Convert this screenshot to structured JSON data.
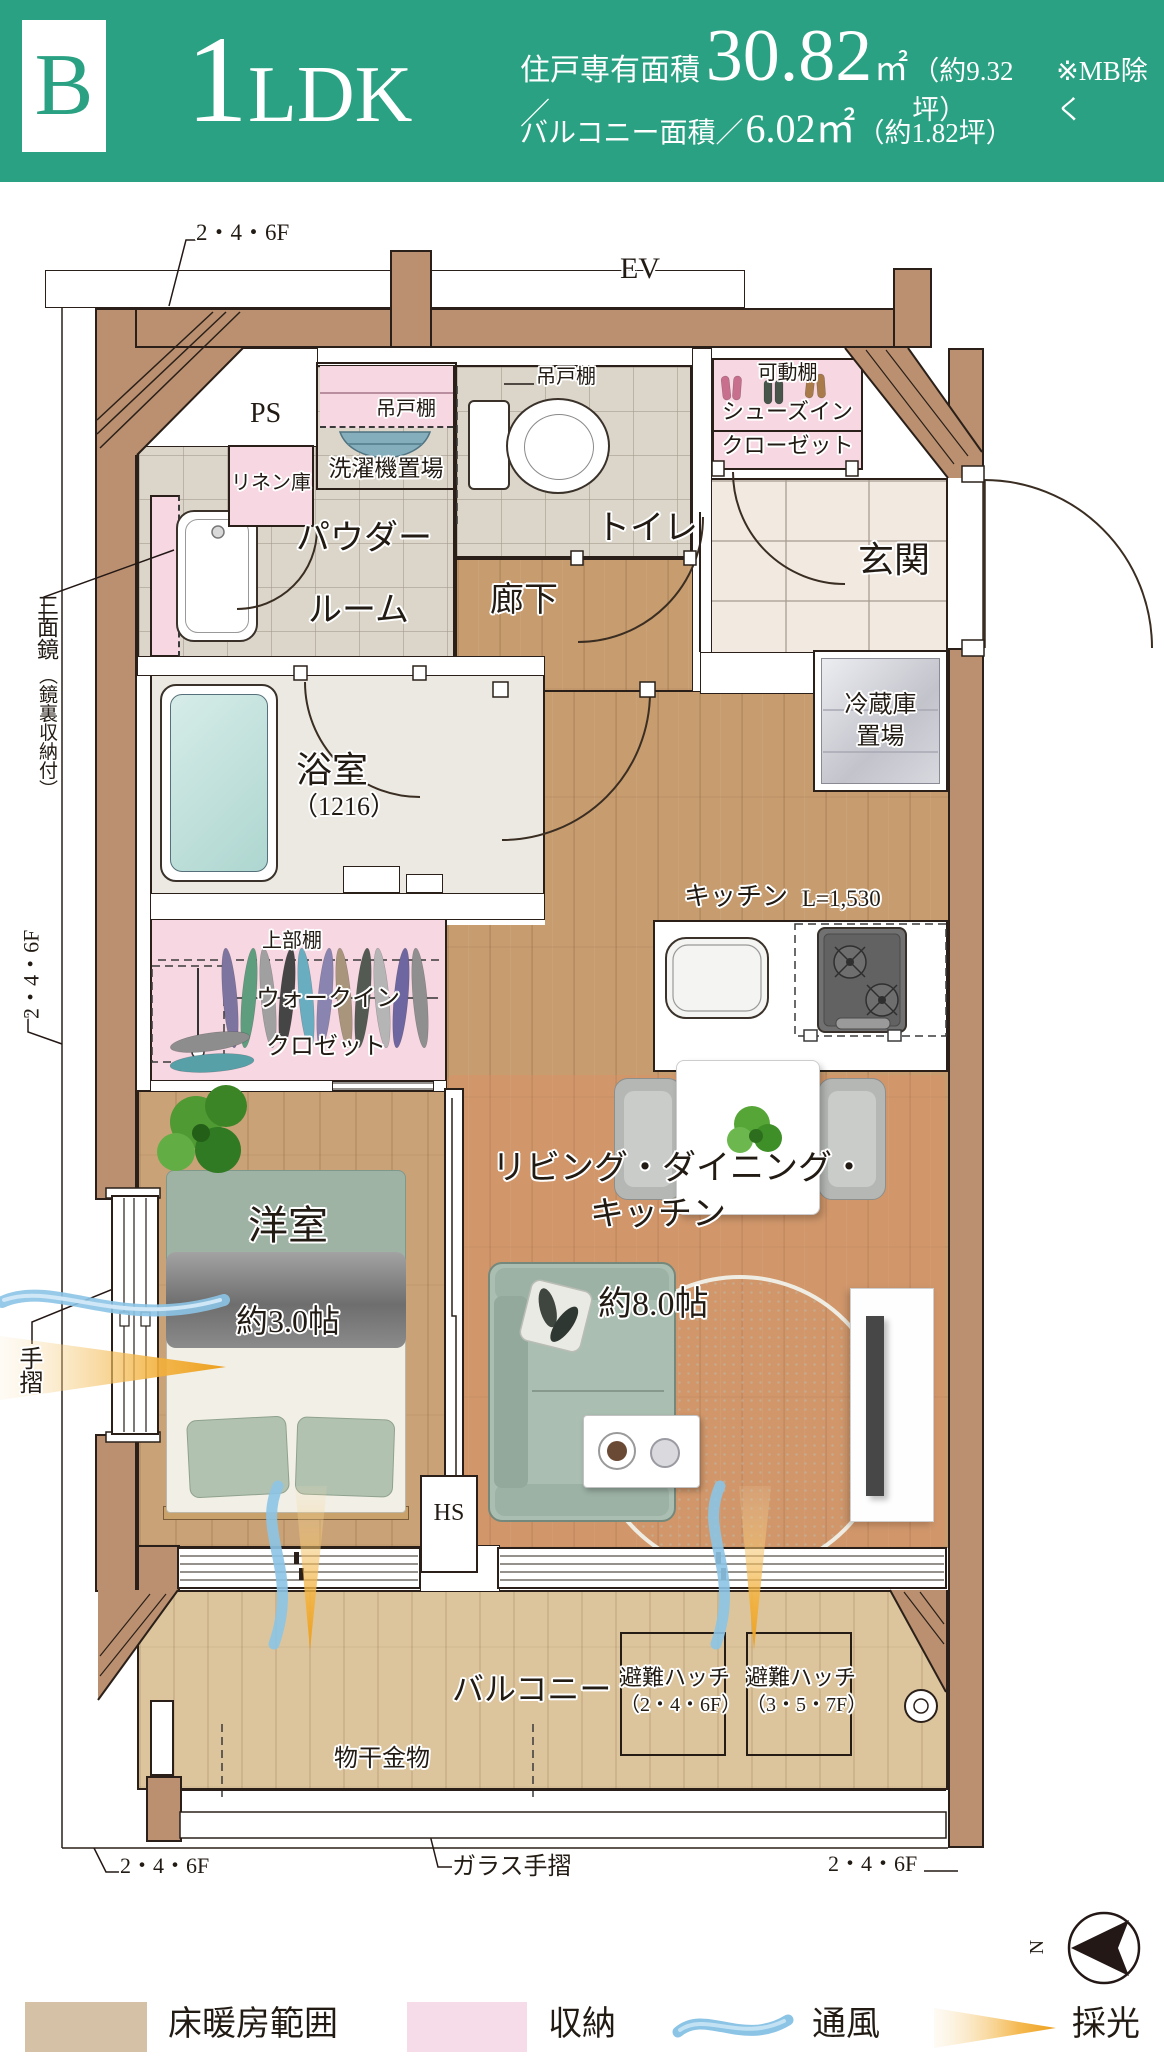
{
  "header": {
    "unit": "B",
    "plan_num": "1",
    "plan_type": "LDK",
    "area_label": "住戸専有面積／",
    "area_value": "30.82",
    "area_unit": "㎡",
    "area_tsubo": "（約9.32坪）",
    "area_note": "※MB除く",
    "balcony_label": "バルコニー面積／",
    "balcony_value": "6.02㎡",
    "balcony_tsubo": "（約1.82坪）"
  },
  "labels": {
    "floor_note_top": "2・4・6F",
    "floor_note_left": "2・4・6F",
    "floor_note_bottom_left": "2・4・6F",
    "floor_note_bottom_right": "2・4・6F",
    "ev": "EV",
    "ps": "PS",
    "hanging_shelf": "吊戸棚",
    "laundry": "洗濯機置場",
    "linen": "リネン庫",
    "toilet": "トイレ",
    "toilet_shelf": "吊戸棚",
    "movable_shelf": "可動棚",
    "sic_line1": "シューズイン",
    "sic_line2": "クローゼット",
    "genkan": "玄関",
    "powder_line1": "パウダー",
    "powder_line2": "ルーム",
    "corridor": "廊下",
    "fridge_line1": "冷蔵庫",
    "fridge_line2": "置場",
    "mirror_line1": "三面鏡",
    "mirror_line2": "（鏡裏収納付）",
    "bath": "浴室",
    "bath_size": "（1216）",
    "kitchen": "キッチン",
    "kitchen_size": "L=1,530",
    "wic_upper": "上部棚",
    "wic_line1": "ウォークイン",
    "wic_line2": "クロゼット",
    "bedroom": "洋室",
    "bedroom_size": "約3.0帖",
    "ldk_line1": "リビング・ダイニング・",
    "ldk_line2": "キッチン",
    "ldk_size": "約8.0帖",
    "hs": "HS",
    "handrail": "手摺",
    "balcony": "バルコニー",
    "laundry_pole": "物干金物",
    "hatch": "避難ハッチ",
    "hatch1_floors": "（2・4・6F）",
    "hatch2_floors": "（3・5・7F）",
    "glass_rail": "ガラス手摺",
    "compass_n": "N"
  },
  "legend": {
    "items": [
      {
        "type": "swatch",
        "color": "#d5c1a6",
        "label": "床暖房範囲"
      },
      {
        "type": "swatch",
        "color": "#f5dce8",
        "label": "収納"
      },
      {
        "type": "wave",
        "color": "#8cc4e6",
        "label": "通風"
      },
      {
        "type": "beam",
        "color": "#f0a32c",
        "label": "採光"
      }
    ]
  },
  "colors": {
    "header_green": "#2aa183",
    "wall_brown": "#bb9070",
    "wood_floor": "#c79c6f",
    "balcony_floor": "#dcc59d",
    "tile_gray": "#dbd6c9",
    "genkan_tile": "#f2e9e0",
    "storage_pink": "#f6d7e2",
    "heating_overlay": "rgba(231,140,100,0.30)",
    "vent_blue": "#8cc4e6",
    "light_orange": "#f0a32c"
  }
}
